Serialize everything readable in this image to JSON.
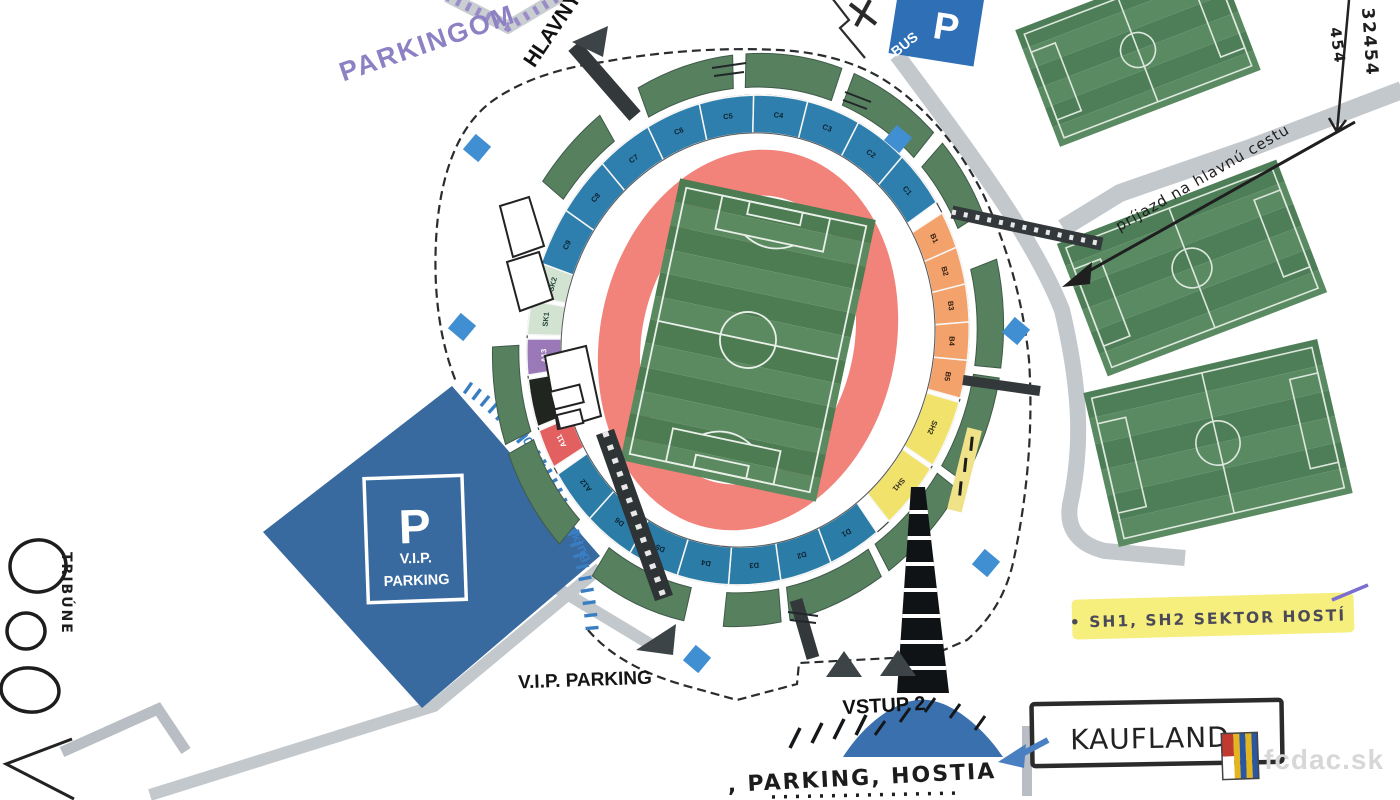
{
  "annotations": {
    "parkingom": "PARKINGOM",
    "hlavny": "HLAVNÝ",
    "bus_p": "P",
    "bus_label": "BUS",
    "vip_sign_p": "P",
    "vip_sign_line1": "V.I.P.",
    "vip_sign_line2": "PARKING",
    "vip_parking_label": "V.I.P. PARKING",
    "skybox_label": "40x Sky Box Parking",
    "vstup2": "VSTUP 2",
    "parking_hostia": ", PARKING, HOSTIA",
    "kaufland": "KAUFLAND",
    "sector_note": "• SH1, SH2  SEKTOR HOSTÍ",
    "access_note": "príjazd na hlavnú cestu",
    "left_note": "TRIBÚNE",
    "right_note_1": "32454",
    "right_note_2": "454",
    "watermark": "fcdac.sk"
  },
  "colors": {
    "stand": "#57805f",
    "track": "#f2837b",
    "pitch_dark": "#4d7c52",
    "pitch_light": "#5b8a60",
    "train_dark": "#4e7e58",
    "train_light": "#5a8a62",
    "vip_blue": "#38699f",
    "gate_blue": "#3f8fd2",
    "road": "#c3c8cd",
    "bus_blue": "#2f6fb5",
    "skybox_blue": "#3a7ec2",
    "highlight": "#f6ee7d",
    "purple_path": "#9a8cc6",
    "mound_blue": "#3a70ad",
    "pitch_line": "#e9f0e9"
  },
  "stadium": {
    "center": {
      "x": 748,
      "y": 340
    },
    "rotation": 12,
    "ring": {
      "rxI": 186,
      "ryI": 208,
      "rxO": 220,
      "ryO": 246
    },
    "track": {
      "rxI": 106,
      "ryI": 146,
      "rxO": 148,
      "ryO": 192
    },
    "pitch": {
      "x": 648,
      "y": 196,
      "w": 200,
      "h": 288
    },
    "stands": {
      "rxI": 228,
      "ryI": 254,
      "rxO": 254,
      "ryO": 288,
      "arcs": [
        [
          -157,
          -139
        ],
        [
          -129,
          -107
        ],
        [
          -104,
          -82
        ],
        [
          -79,
          -57
        ],
        [
          -54,
          -37
        ],
        [
          -27,
          -5
        ],
        [
          -3,
          19
        ],
        [
          21,
          43
        ],
        [
          45,
          67
        ],
        [
          69,
          82
        ],
        [
          91,
          114
        ],
        [
          124,
          146
        ],
        [
          148,
          168
        ]
      ]
    },
    "sections": [
      {
        "label": "C9",
        "color": "#2e7fae",
        "text": "#0d2330",
        "start": -173,
        "end": -158.8
      },
      {
        "label": "C8",
        "color": "#2e7fae",
        "text": "#0d2330",
        "start": -158.8,
        "end": -144.6
      },
      {
        "label": "C7",
        "color": "#2e7fae",
        "text": "#0d2330",
        "start": -144.6,
        "end": -130.3
      },
      {
        "label": "C6",
        "color": "#2e7fae",
        "text": "#0d2330",
        "start": -130.3,
        "end": -116.1
      },
      {
        "label": "C5",
        "color": "#2e7fae",
        "text": "#0d2330",
        "start": -116.1,
        "end": -101.9
      },
      {
        "label": "C4",
        "color": "#2e7fae",
        "text": "#0d2330",
        "start": -101.9,
        "end": -87.7
      },
      {
        "label": "C3",
        "color": "#2e7fae",
        "text": "#0d2330",
        "start": -87.7,
        "end": -73.4
      },
      {
        "label": "C2",
        "color": "#2e7fae",
        "text": "#0d2330",
        "start": -73.4,
        "end": -59.2
      },
      {
        "label": "C1",
        "color": "#2e7fae",
        "text": "#0d2330",
        "start": -59.2,
        "end": -45
      },
      {
        "label": "B1",
        "color": "#f4a26b",
        "text": "#301e10",
        "start": -42,
        "end": -33
      },
      {
        "label": "B2",
        "color": "#f4a26b",
        "text": "#301e10",
        "start": -33,
        "end": -24
      },
      {
        "label": "B3",
        "color": "#f4a26b",
        "text": "#301e10",
        "start": -24,
        "end": -15
      },
      {
        "label": "B4",
        "color": "#f4a26b",
        "text": "#301e10",
        "start": -15,
        "end": -6
      },
      {
        "label": "B5",
        "color": "#f4a26b",
        "text": "#301e10",
        "start": -6,
        "end": 3
      },
      {
        "label": "SH2",
        "color": "#f1e26b",
        "text": "#33301a",
        "start": 4,
        "end": 20
      },
      {
        "label": "SH1",
        "color": "#f1e26b",
        "text": "#33301a",
        "start": 21,
        "end": 37
      },
      {
        "label": "D1",
        "color": "#2b7da8",
        "text": "#0d2330",
        "start": 41,
        "end": 54.6
      },
      {
        "label": "D2",
        "color": "#2b7da8",
        "text": "#0d2330",
        "start": 54.6,
        "end": 68.1
      },
      {
        "label": "D3",
        "color": "#2b7da8",
        "text": "#0d2330",
        "start": 68.1,
        "end": 81.7
      },
      {
        "label": "D4",
        "color": "#2b7da8",
        "text": "#0d2330",
        "start": 81.7,
        "end": 95.3
      },
      {
        "label": "D5",
        "color": "#2b7da8",
        "text": "#0d2330",
        "start": 95.3,
        "end": 108.9
      },
      {
        "label": "D6",
        "color": "#2b7da8",
        "text": "#0d2330",
        "start": 108.9,
        "end": 122.4
      },
      {
        "label": "A12",
        "color": "#2b7da8",
        "text": "#0d2330",
        "start": 122.4,
        "end": 136
      },
      {
        "label": "A11",
        "color": "#e2605f",
        "text": "#ffffff",
        "start": 138,
        "end": 147.5
      },
      {
        "label": "",
        "color": "#20261f",
        "text": "#ffffff",
        "start": 148.5,
        "end": 160
      },
      {
        "label": "A13",
        "color": "#9b79b8",
        "text": "#ffffff",
        "start": 161,
        "end": 169.5
      },
      {
        "label": "SK1",
        "color": "#d2e3d2",
        "text": "#24463b",
        "start": 170.5,
        "end": 178.5
      },
      {
        "label": "SK2",
        "color": "#d2e3d2",
        "text": "#24463b",
        "start": 179.5,
        "end": 187.5
      }
    ]
  },
  "training_pitches": [
    {
      "cx": 1138,
      "cy": 50,
      "w": 215,
      "h": 125,
      "rot": -21
    },
    {
      "cx": 1192,
      "cy": 268,
      "w": 235,
      "h": 142,
      "rot": -21
    },
    {
      "cx": 1218,
      "cy": 443,
      "w": 240,
      "h": 158,
      "rot": -13
    }
  ],
  "gates": [
    [
      477,
      148
    ],
    [
      462,
      327
    ],
    [
      898,
      139
    ],
    [
      1016,
      331
    ],
    [
      986,
      563
    ],
    [
      697,
      659
    ]
  ],
  "skybox_arc": {
    "p0": [
      468,
      388
    ],
    "p1": [
      578,
      466
    ],
    "p2": [
      592,
      628
    ],
    "count": 25
  }
}
